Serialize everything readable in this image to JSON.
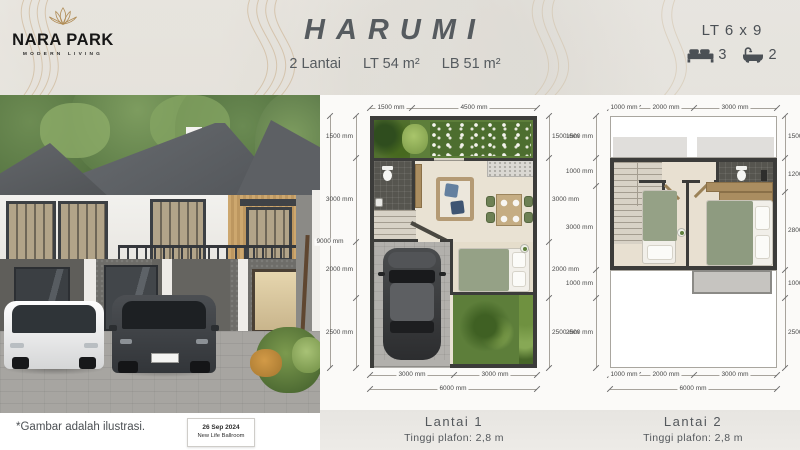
{
  "brand": {
    "name": "NARA PARK",
    "tagline": "MODERN LIVING",
    "logo_icon": "lotus-icon"
  },
  "header": {
    "title": "HARUMI",
    "subtitle": {
      "floors": "2 Lantai",
      "land": "LT 54 m²",
      "building": "LB 51 m²"
    },
    "lot_size": "LT 6 x 9",
    "bedrooms": "3",
    "bathrooms": "2",
    "bed_icon": "bed-icon",
    "bath_icon": "bath-icon"
  },
  "photo": {
    "disclaimer": "*Gambar adalah ilustrasi.",
    "stamp_date": "26 Sep 2024",
    "stamp_venue": "New Life Ballroom"
  },
  "plans": [
    {
      "name": "Lantai 1",
      "ceiling": "Tinggi plafon: 2,8 m",
      "dims": {
        "top": [
          "1500 mm",
          "4500 mm"
        ],
        "left": [
          "1500 mm",
          "3000 mm",
          "2000 mm",
          "2500 mm"
        ],
        "left_total": "9000 mm",
        "right": [
          "1500 mm",
          "3000 mm",
          "2000 mm",
          "2500 mm"
        ],
        "bottom": [
          "3000 mm",
          "3000 mm"
        ],
        "bottom_total": "6000 mm"
      }
    },
    {
      "name": "Lantai 2",
      "ceiling": "Tinggi plafon: 2,8 m",
      "dims": {
        "top": [
          "1000 mm",
          "2000 mm",
          "3000 mm"
        ],
        "left": [
          "1500 mm",
          "1000 mm",
          "3000 mm",
          "1000 mm",
          "2500 mm"
        ],
        "right": [
          "1500 mm",
          "1200 mm",
          "2800 mm",
          "1000 mm",
          "2500 mm"
        ],
        "bottom": [
          "1000 mm",
          "2000 mm",
          "3000 mm"
        ],
        "bottom_total": "6000 mm"
      }
    }
  ],
  "colors": {
    "accent_gold": "#b08d57",
    "title_text": "#565b5f",
    "wall": "#3c3c3a",
    "garden_green": "#5d7e3a",
    "floor_beige": "#e9e2d3"
  }
}
